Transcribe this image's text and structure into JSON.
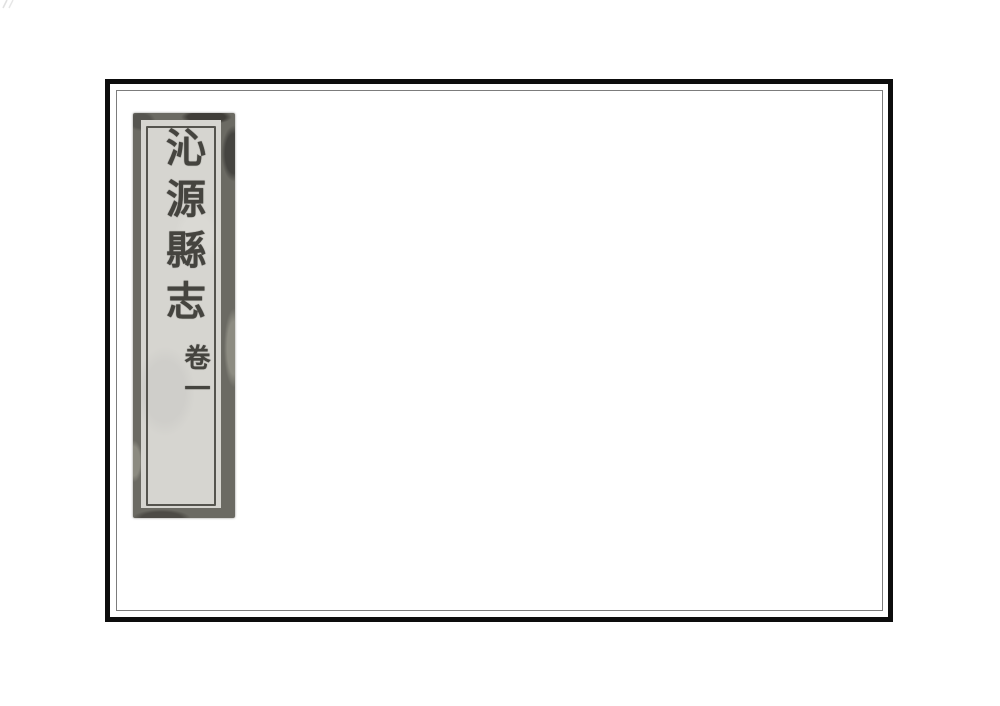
{
  "cover_label": {
    "title": "沁源縣志",
    "volume": "卷一"
  },
  "colors": {
    "page_background": "#ffffff",
    "frame_outer": "#0d0d0d",
    "frame_inner_line": "#7c7c7c",
    "label_border": "#6b6a63",
    "label_paper": "#d6d5d0",
    "ink": "#45443f"
  }
}
